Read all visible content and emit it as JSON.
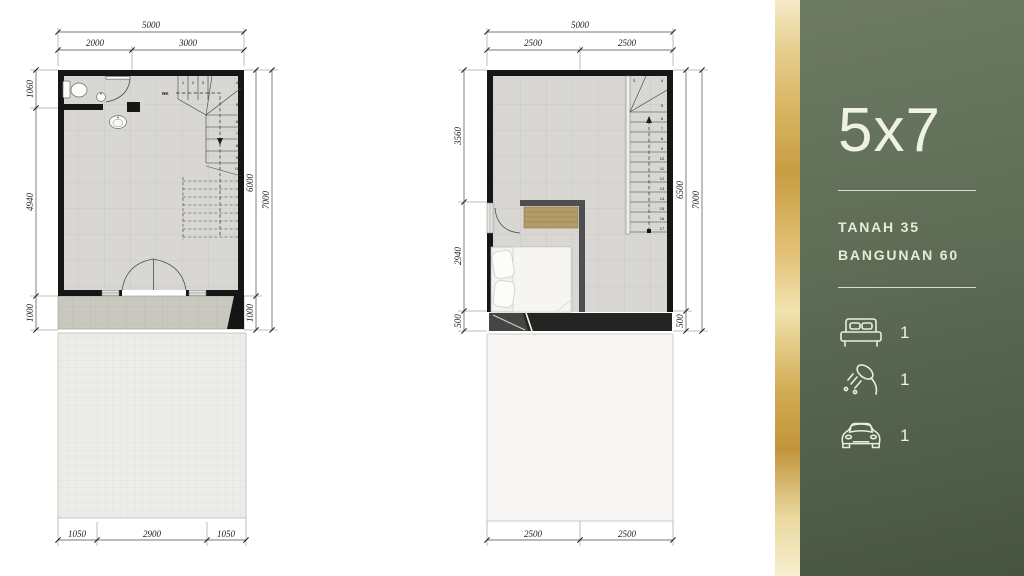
{
  "panel": {
    "title": "5x7",
    "specs": {
      "tanah": "TANAH 35",
      "bangunan": "BANGUNAN 60"
    },
    "amenities": [
      {
        "name": "bed",
        "count": "1"
      },
      {
        "name": "shower",
        "count": "1"
      },
      {
        "name": "car",
        "count": "1"
      }
    ],
    "colors": {
      "green_top": "#6d7a64",
      "green_bottom": "#475441",
      "gold": "#d8b564",
      "text": "#eaeedb"
    }
  },
  "ground_plan": {
    "dims": {
      "top_total": "5000",
      "top_left": "2000",
      "top_right": "3000",
      "left_top": "1060",
      "left_mid": "4940",
      "left_bottom": "1000",
      "right_inner": "6000",
      "right_porch": "1000",
      "right_outer": "7000",
      "bottom_left": "1050",
      "bottom_mid": "2900",
      "bottom_right": "1050"
    },
    "stairs": {
      "up_label": "NK",
      "steps": [
        "1",
        "2",
        "3",
        "4",
        "5",
        "6",
        "7",
        "8",
        "9",
        "10"
      ]
    }
  },
  "upper_plan": {
    "dims": {
      "top_total": "5000",
      "top_left": "2500",
      "top_right": "2500",
      "left_top": "3560",
      "left_mid": "2940",
      "left_bottom": "500",
      "right_inner": "6500",
      "right_bottom": "500",
      "right_outer": "7000",
      "bottom_left": "2500",
      "bottom_right": "2500"
    },
    "stairs": {
      "steps": [
        "3",
        "4",
        "5",
        "6",
        "7",
        "8",
        "9",
        "10",
        "11",
        "12",
        "13",
        "14",
        "15",
        "16",
        "17"
      ]
    }
  }
}
